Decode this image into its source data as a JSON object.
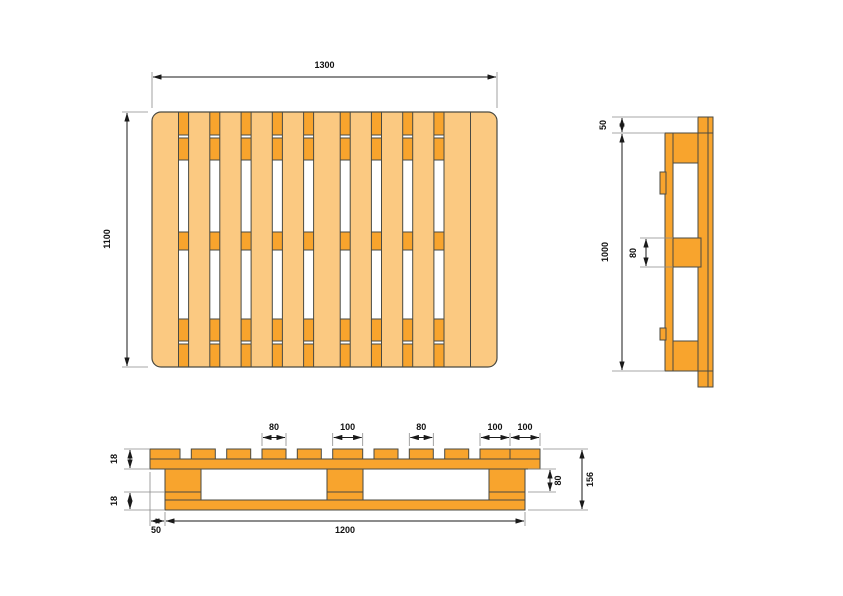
{
  "drawing": {
    "top_view": {
      "width": "1300",
      "depth": "1100"
    },
    "side_view": {
      "overhang": "50",
      "inner_height": "1000",
      "bearer_width": "80"
    },
    "front_view": {
      "board_widths": [
        "80",
        "100",
        "80",
        "100",
        "100"
      ],
      "top_deck_thickness": "18",
      "bottom_deck_thickness": "18",
      "end_overhang": "50",
      "bearer_span": "1200",
      "bearer_height": "80",
      "overall_height": "156"
    },
    "colors": {
      "wood_light": "#FBC981",
      "wood_dark": "#F8A42D",
      "outline": "#4A4A42",
      "dimension_line": "#1A1A1A"
    }
  }
}
